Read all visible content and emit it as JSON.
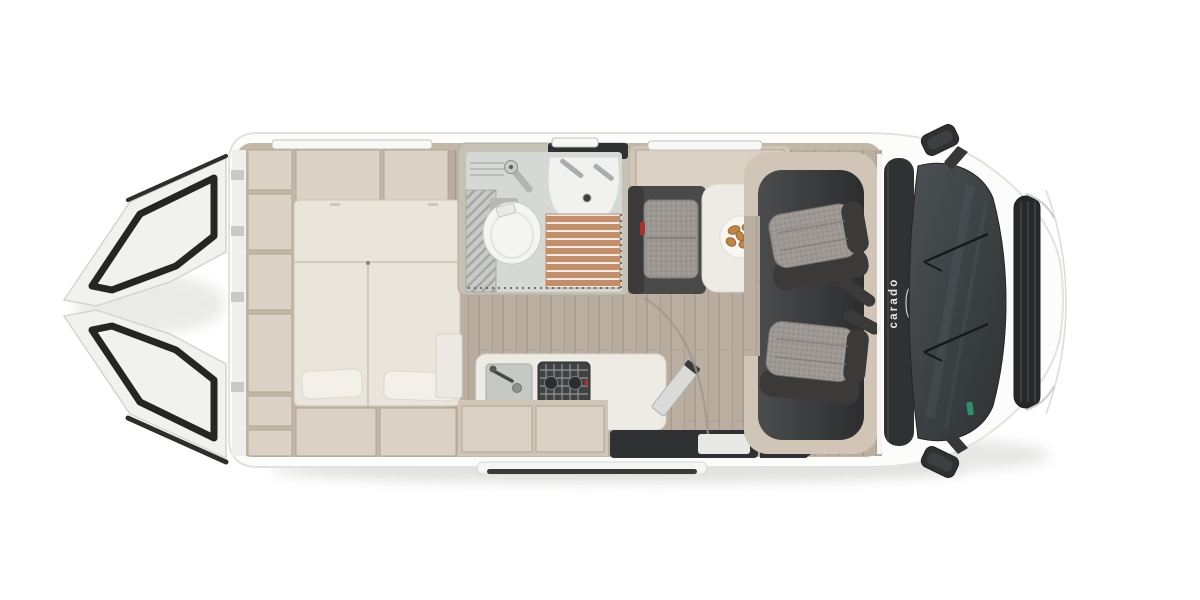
{
  "brand": {
    "logo_text": "carado"
  },
  "colors": {
    "page_bg": "#ffffff",
    "body_white": "#fcfcfb",
    "body_edge": "#e2e2e0",
    "wall_beige": "#d0c5b6",
    "wall_beige_light": "#dbd2c5",
    "wall_deep": "#c3b7a7",
    "wall_divider": "#b1a593",
    "mattress": "#eae5da",
    "mattress_seam": "#cbc3b3",
    "pillow": "#f3f0e9",
    "floor_wood": "#b7ac9e",
    "floor_wood_light": "#c3b8aa",
    "floor_wood_line": "#a2978a",
    "bath_wall": "#c6c1b5",
    "bath_floor": "#d6d8d6",
    "rib_grey": "#c9cac7",
    "rib_line": "#9da09d",
    "shower_wood": "#c28e6b",
    "shower_gap": "#f0e9e1",
    "toilet": "#f4f4f2",
    "sink_white": "#f1f2f0",
    "fixture_line": "#c9c9c5",
    "chrome": "#aaadae",
    "dark_panel": "#2f3132",
    "cab_floor_hi": "#4a4c4e",
    "cab_floor": "#2b2d2e",
    "seat_grey": "#9c9792",
    "seat_grey_dark": "#7c7772",
    "seat_dark": "#3b3a38",
    "bench_dark": "#4a4947",
    "accent_red": "#a83232",
    "table_white": "#edebe4",
    "plate": "#f7f6f3",
    "croissant": "#c08448",
    "croissant_dark": "#9c6a33",
    "glass_hi": "#4b5053",
    "glass": "#2e3234",
    "grille": "#26282a",
    "window_strip": "#f8f8f6",
    "window_edge": "#bfbfbc",
    "sticker_green": "#2f8f6a",
    "logo": "#e6e6e4",
    "door_white": "#f1f1ef",
    "door_frame": "#242524",
    "hob_dark": "#3f4142",
    "rail_dark": "#3a3a38"
  }
}
